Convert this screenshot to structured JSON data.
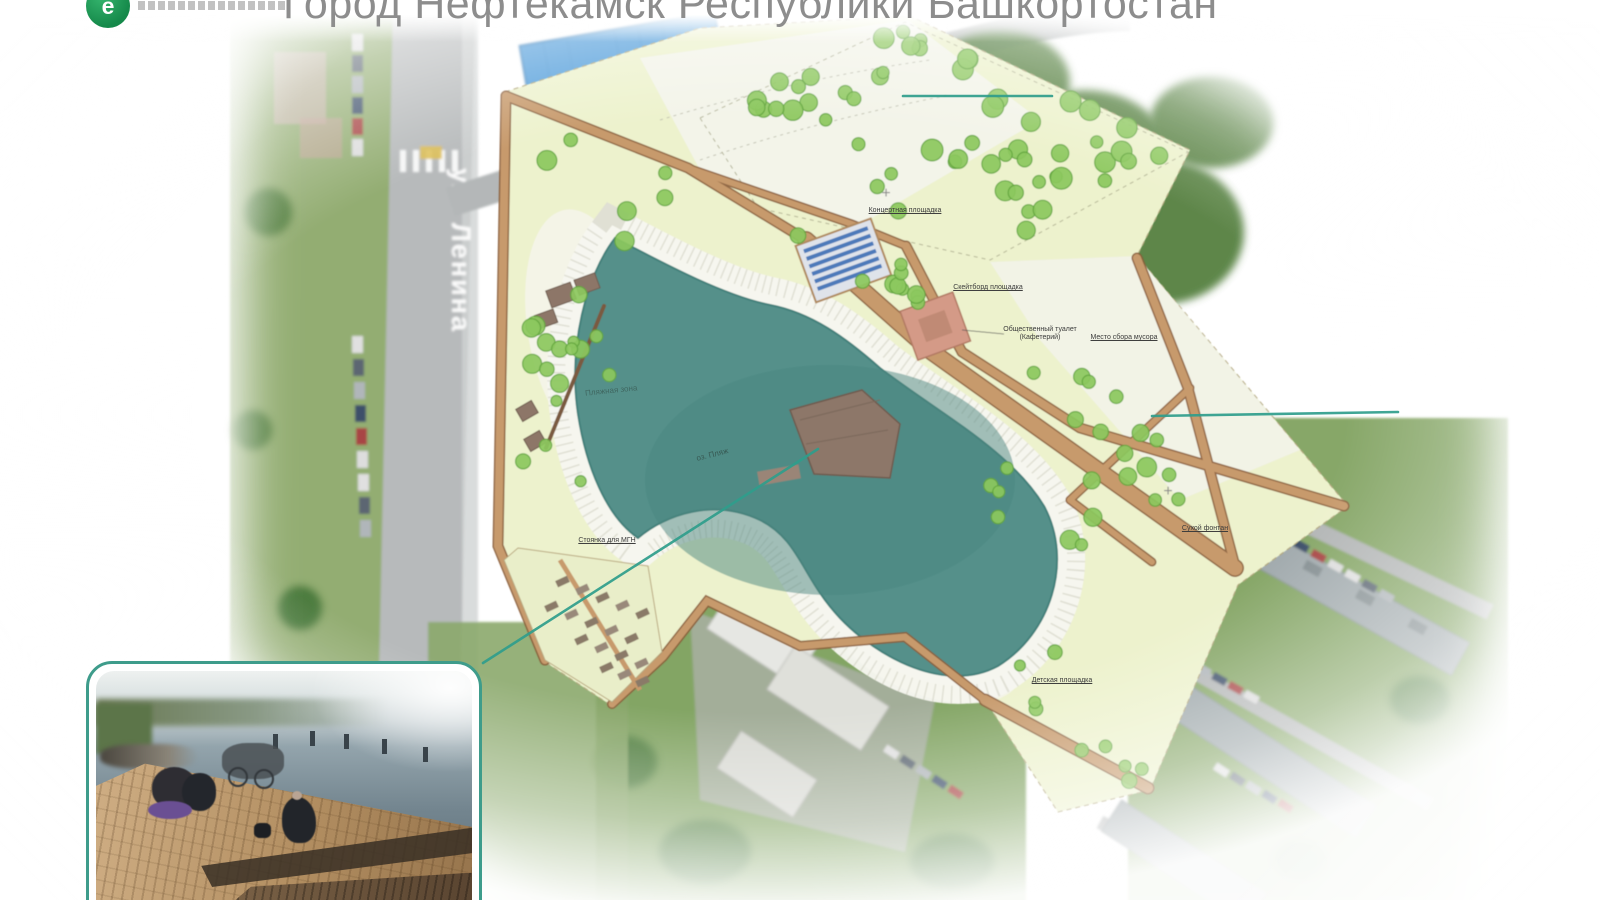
{
  "header": {
    "title": "Город Нефтекамск Республики Башкортостан"
  },
  "map": {
    "street_label": "ул. Ленина",
    "pond_label": "оз. Пляж",
    "beach_label": "Пляжная зона",
    "plan_labels": [
      {
        "text": "Концертная площадка"
      },
      {
        "text": "Скейтборд площадка"
      },
      {
        "text": "Общественный туалет (Кафетерий)"
      },
      {
        "text": "Место сбора мусора"
      },
      {
        "text": "Стоянка для МГН"
      },
      {
        "text": "Сухой фонтан"
      },
      {
        "text": "Детская площадка"
      }
    ],
    "plus_mark": "+"
  },
  "colors": {
    "title_gray": "#8d8d8d",
    "logo_green": "#1b9552",
    "callout_teal": "#2f9e8c",
    "inset_border": "#3e9c8b",
    "plan_ground": "#edf2cd",
    "pond_teal": "#54908a",
    "path_tan": "#c79a6c",
    "tree_green": "#8cc85e",
    "blue_roof": "#58a1dc"
  },
  "logo_letter": "е"
}
